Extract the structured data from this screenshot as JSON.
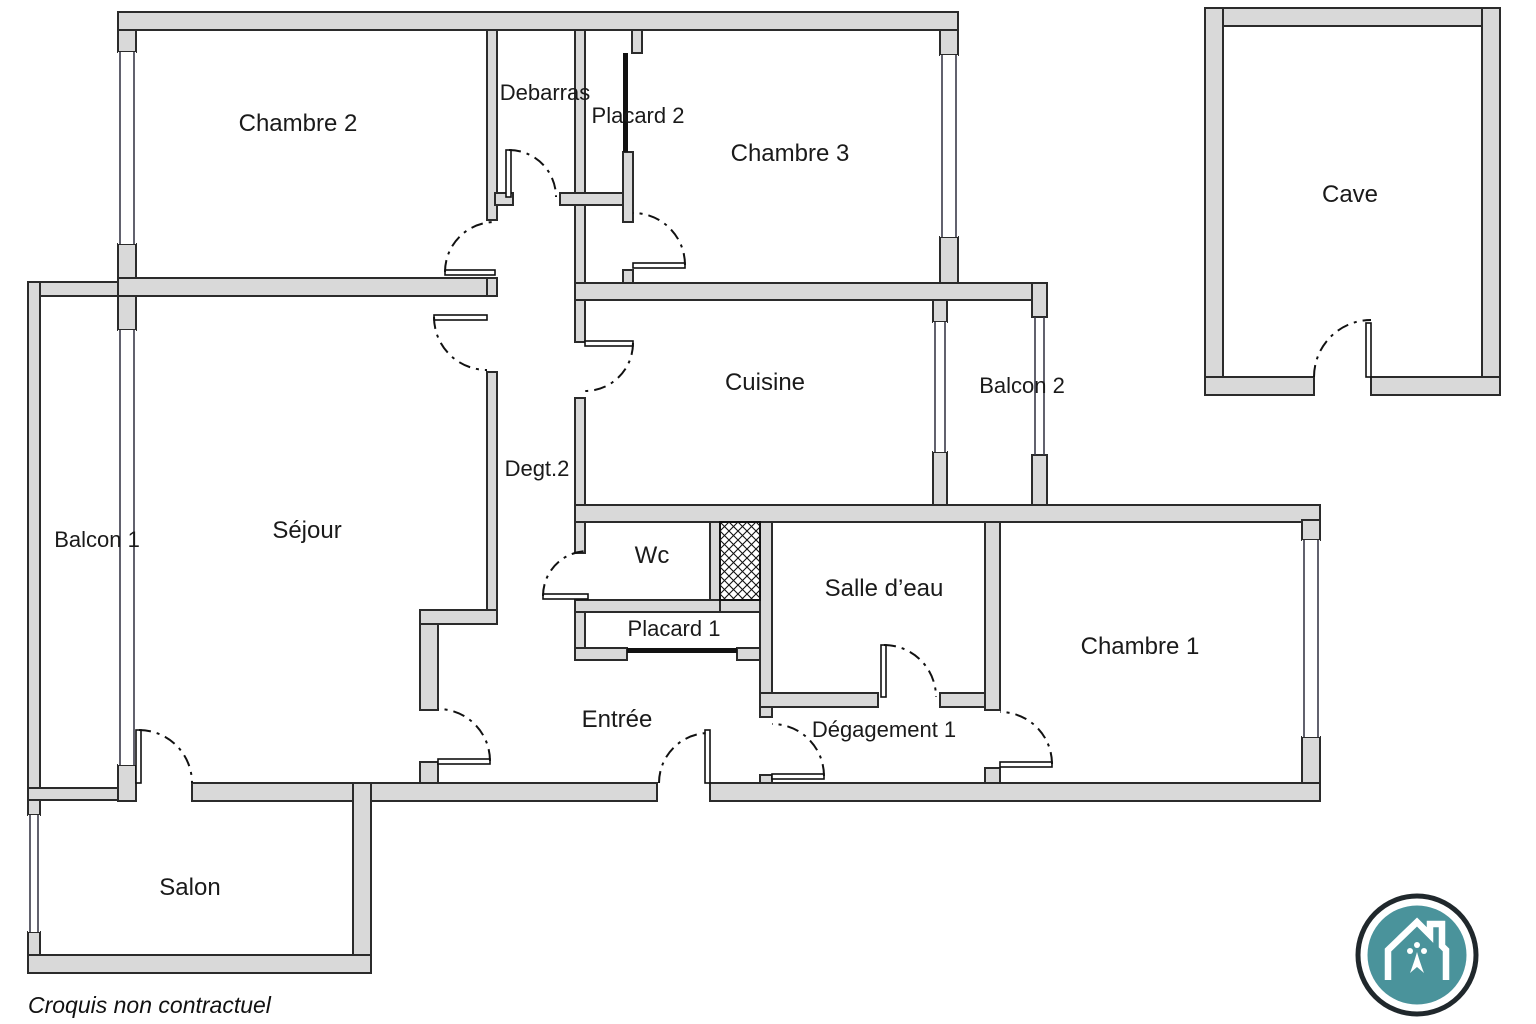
{
  "floor_plan": {
    "rooms": {
      "chambre_2": {
        "label": "Chambre 2"
      },
      "debarras": {
        "label": "Debarras"
      },
      "placard_2": {
        "label": "Placard 2"
      },
      "chambre_3": {
        "label": "Chambre 3"
      },
      "cave": {
        "label": "Cave"
      },
      "balcon_1": {
        "label": "Balcon 1"
      },
      "sejour": {
        "label": "Séjour"
      },
      "degt_2": {
        "label": "Degt.2"
      },
      "cuisine": {
        "label": "Cuisine"
      },
      "balcon_2": {
        "label": "Balcon 2"
      },
      "wc": {
        "label": "Wc"
      },
      "salle_deau": {
        "label": "Salle d’eau"
      },
      "chambre_1": {
        "label": "Chambre 1"
      },
      "placard_1": {
        "label": "Placard 1"
      },
      "entree": {
        "label": "Entrée"
      },
      "degagement_1": {
        "label": "Dégagement 1"
      },
      "salon": {
        "label": "Salon"
      }
    },
    "caption": "Croquis non contractuel",
    "colors": {
      "background": "#ffffff",
      "wall_fill": "#d9d9d9",
      "wall_stroke": "#2b2b2b",
      "text": "#1a1a1a",
      "logo_teal": "#4a939b",
      "logo_ring": "#20282c"
    }
  }
}
